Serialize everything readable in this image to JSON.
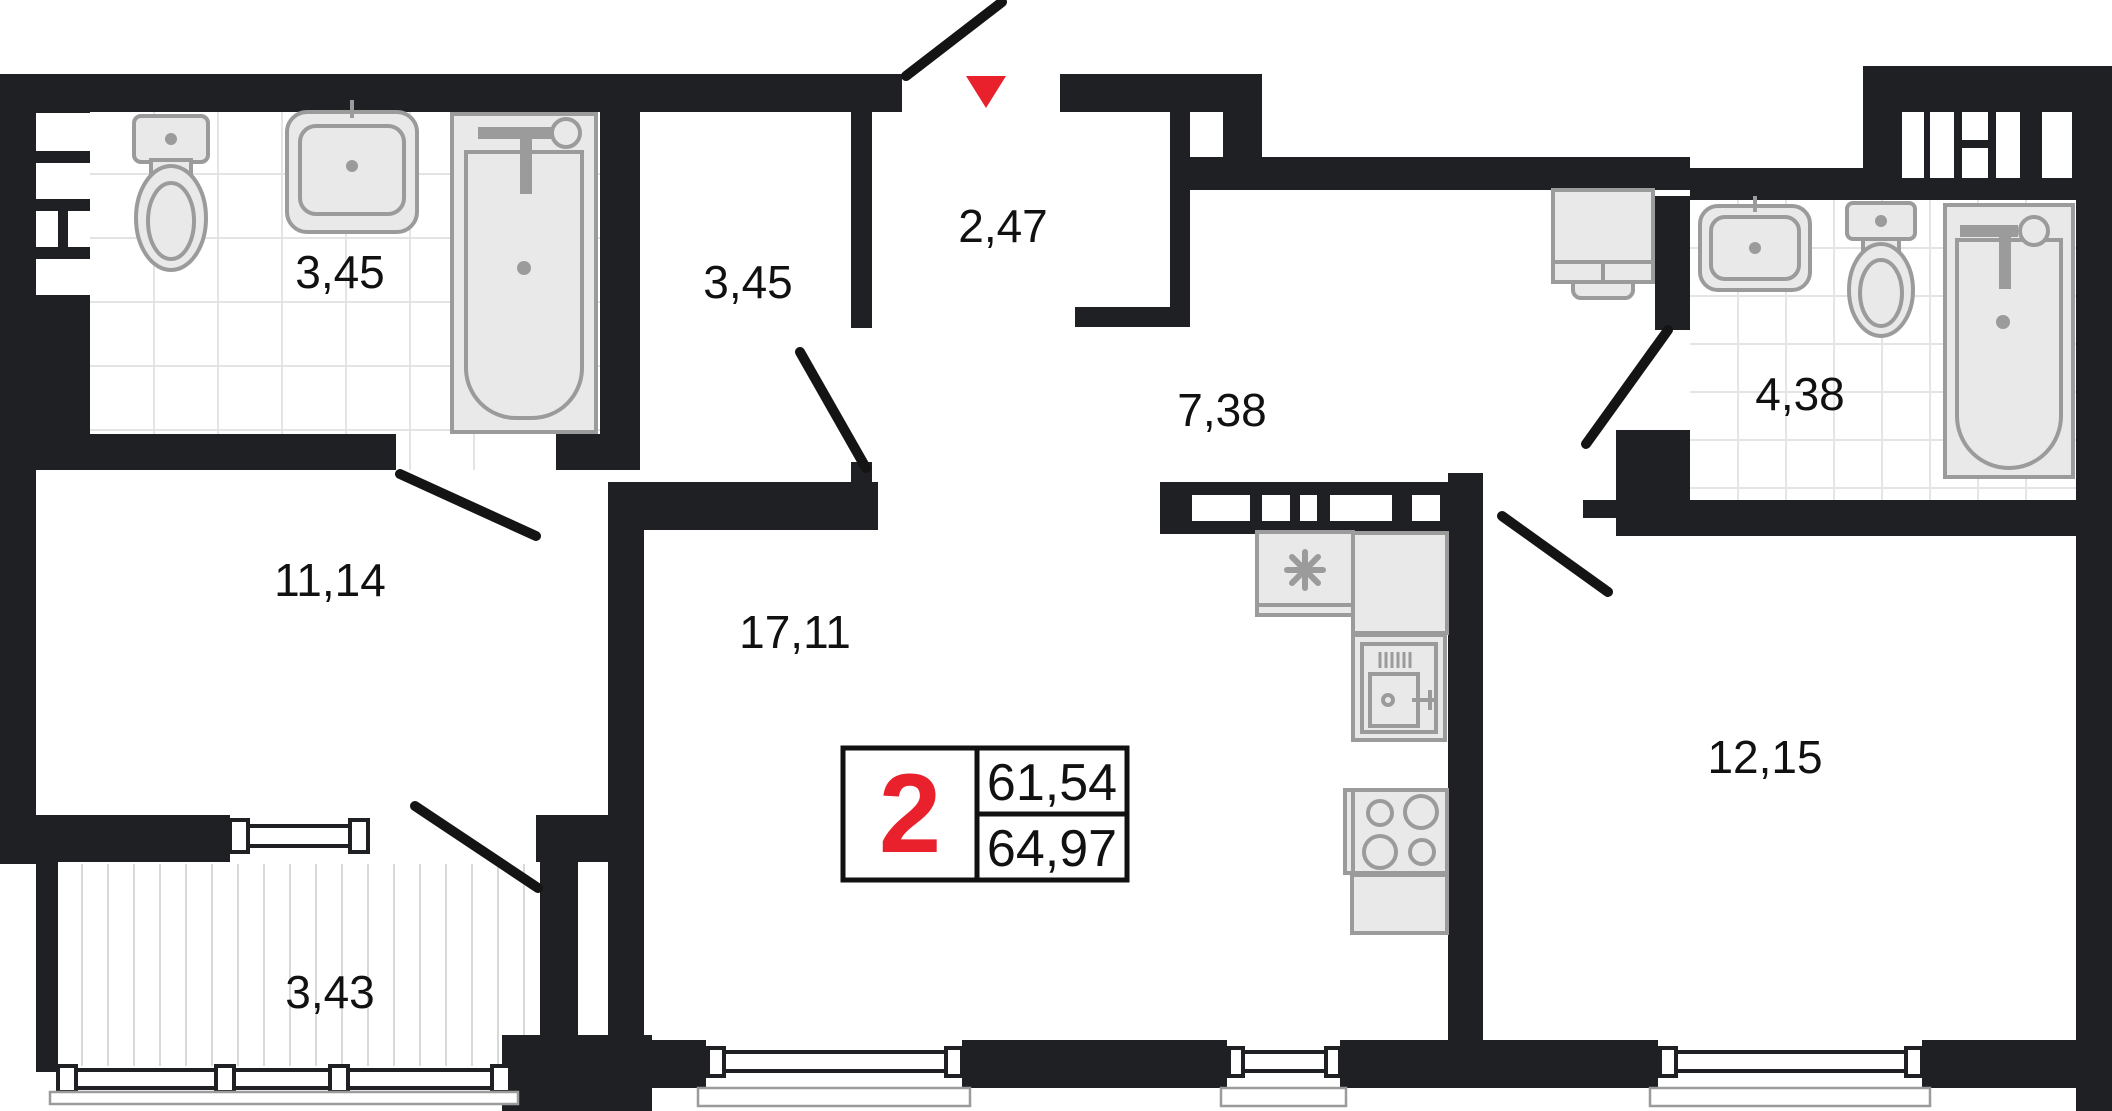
{
  "plan": {
    "badge": {
      "rooms_count": "2",
      "area_living": "61,54",
      "area_total": "64,97"
    },
    "rooms": [
      {
        "id": "bathroom-1",
        "label": "3,45"
      },
      {
        "id": "closet",
        "label": "3,45"
      },
      {
        "id": "entrance-hall",
        "label": "2,47"
      },
      {
        "id": "corridor",
        "label": "7,38"
      },
      {
        "id": "bathroom-2",
        "label": "4,38"
      },
      {
        "id": "room-11",
        "label": "11,14"
      },
      {
        "id": "living-kitchen",
        "label": "17,11"
      },
      {
        "id": "bedroom",
        "label": "12,15"
      },
      {
        "id": "balcony",
        "label": "3,43"
      }
    ],
    "markers": {
      "entrance": "red-triangle-down"
    },
    "colors": {
      "wall": "#1f2023",
      "accent_red": "#e8212d",
      "fixture_fill": "#e9e9e9",
      "fixture_stroke": "#9b9b9b",
      "tile_line": "#e4e4e4",
      "stripe_line": "#d9d9d9"
    }
  }
}
